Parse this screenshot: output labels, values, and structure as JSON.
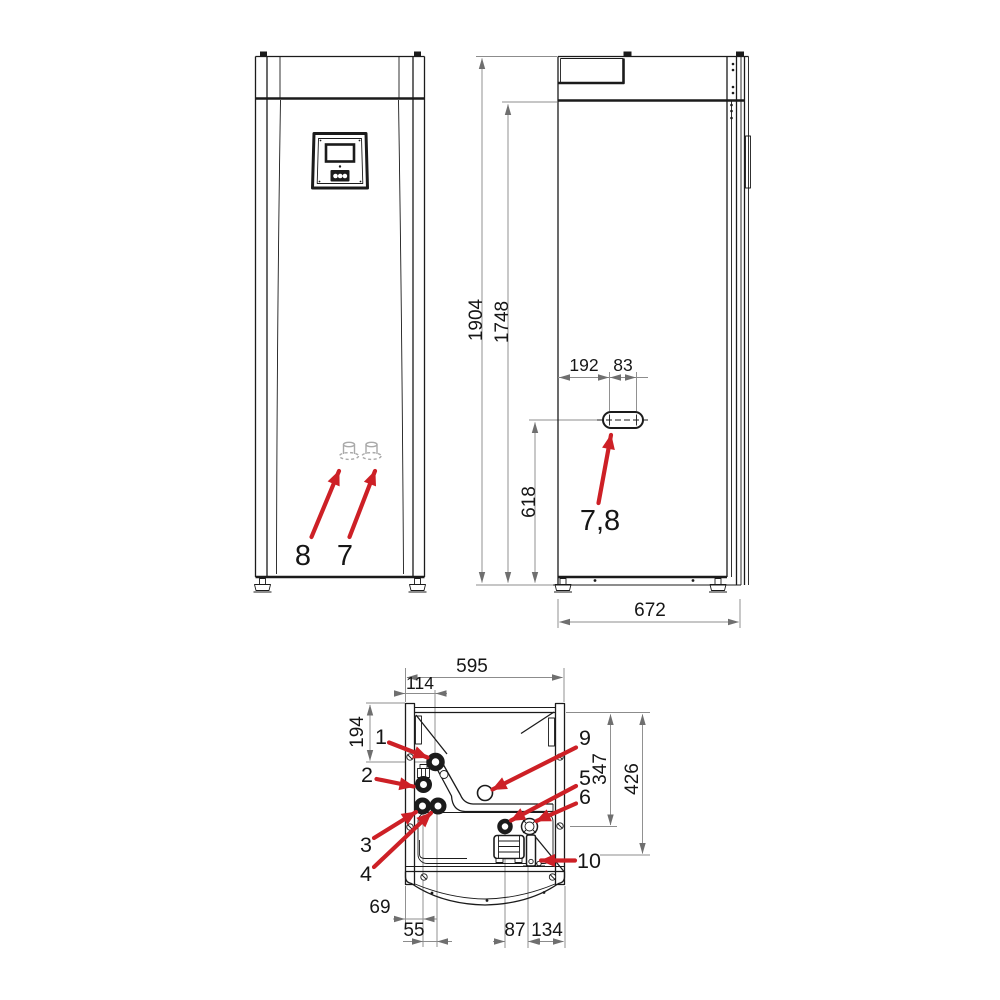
{
  "document": {
    "kind": "appliance dimensional drawing"
  },
  "views": {
    "front": {
      "callouts": [
        "8",
        "7"
      ]
    },
    "side": {
      "dimensions": {
        "total_height": "1904",
        "body_height": "1748",
        "connection_height": "618",
        "connection_offset": "192",
        "connection_spacing": "83",
        "depth": "672"
      },
      "callout": "7,8"
    },
    "bottom": {
      "dimensions": {
        "width": "595",
        "offset_114": "114",
        "depth_194": "194",
        "depth_347": "347",
        "depth_426": "426",
        "offset_69": "69",
        "offset_55": "55",
        "offset_87": "87",
        "offset_134": "134"
      },
      "callouts": [
        "1",
        "2",
        "3",
        "4",
        "9",
        "5",
        "6",
        "10"
      ]
    }
  },
  "colors": {
    "callout_arrow": "#cd2026",
    "drawing_line": "#1b1b1b",
    "dimension_line": "#8c8c8c",
    "background": "#ffffff"
  }
}
